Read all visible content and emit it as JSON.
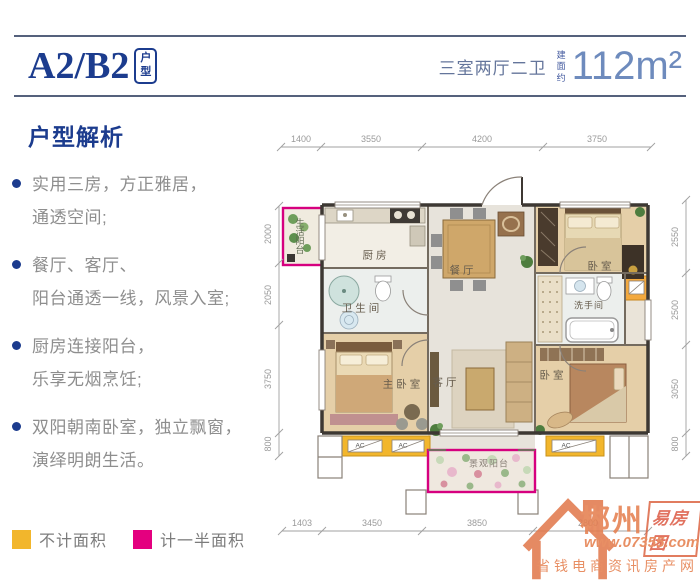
{
  "header": {
    "plan_code": "A2/B2",
    "plan_tag": "户型",
    "layout_desc": "三室两厅二卫",
    "area_prefix": "建面约",
    "area_value": "112m²"
  },
  "analysis": {
    "title": "户型解析",
    "bullets": [
      {
        "line1": "实用三房，方正雅居，",
        "line2": "通透空间;"
      },
      {
        "line1": "餐厅、客厅、",
        "line2": "阳台通透一线，风景入室;"
      },
      {
        "line1": "厨房连接阳台，",
        "line2": "乐享无烟烹饪;"
      },
      {
        "line1": "双阳朝南卧室，独立飘窗，",
        "line2": "演绎明朗生活。"
      }
    ]
  },
  "floorplan": {
    "rooms": {
      "life_balcony": "生活阳台",
      "kitchen": "厨房",
      "bathroom": "卫生间",
      "dining": "餐厅",
      "bedroom_top": "卧室",
      "washroom": "洗手间",
      "master_bedroom": "主卧室",
      "living": "客厅",
      "bedroom_bottom": "卧室",
      "view_balcony": "景观阳台"
    },
    "ac_label": "AC",
    "dims": {
      "top": [
        "1400",
        "3550",
        "4200",
        "3750"
      ],
      "bottom": [
        "1403",
        "3450",
        "3850",
        "2800"
      ],
      "left": [
        "2000",
        "2050",
        "3750",
        "800"
      ],
      "right": [
        "2550",
        "2500",
        "3050",
        "800"
      ]
    }
  },
  "legend": {
    "no_area": {
      "label": "不计面积",
      "color": "#f2b62c"
    },
    "half_area": {
      "label": "计一半面积",
      "color": "#e4007f"
    }
  },
  "watermark": {
    "city": "郴州",
    "brand": "易房团",
    "url": "www.07355.com",
    "slogan": "省钱电商资讯房产网"
  }
}
